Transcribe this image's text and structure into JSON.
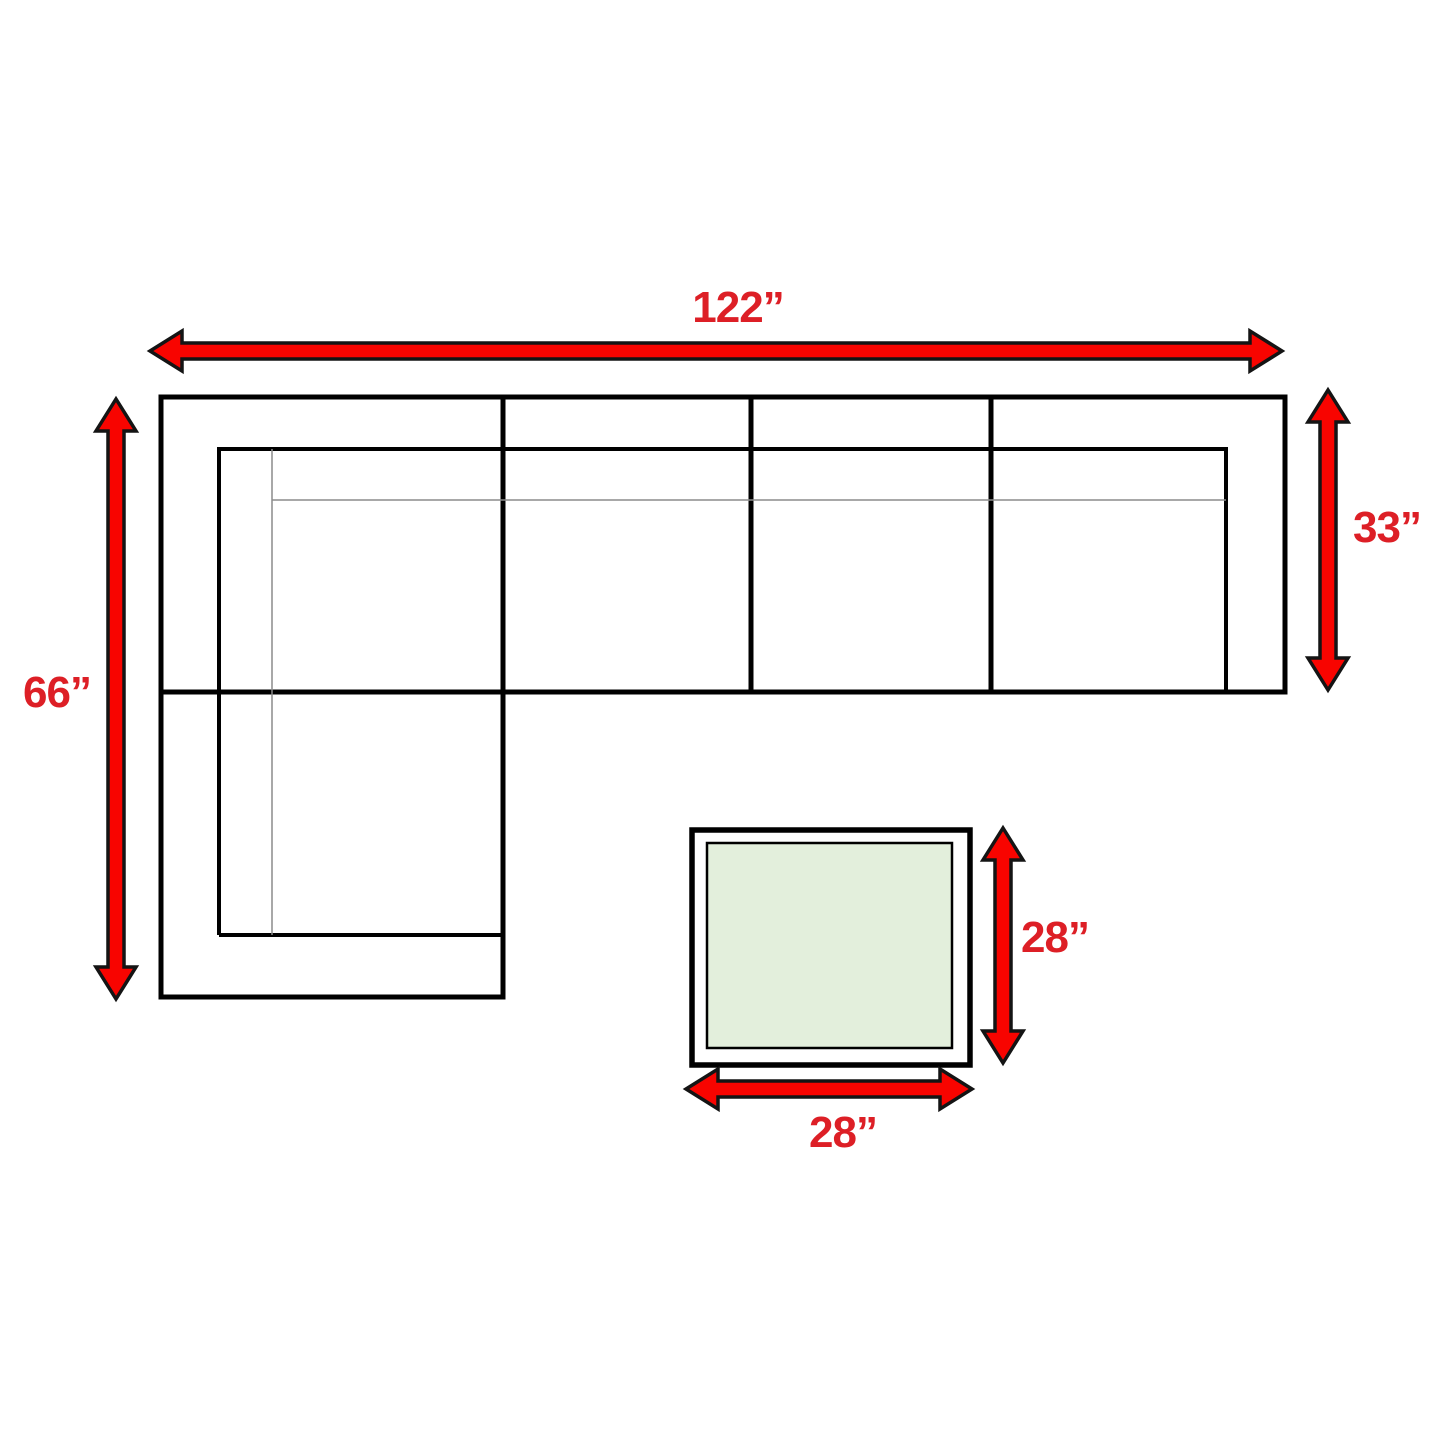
{
  "title": "Sectional sofa with table dimension diagram",
  "colors": {
    "background": "#FFFFFF",
    "arrow_fill": "#F80400",
    "arrow_outline": "#141414",
    "label_color": "#DD1F26",
    "sofa_line_color": "#000000",
    "thin_line_color": "#8C8C8C",
    "table_line_color": "#000000",
    "table_top_fill": "#E3EFDC"
  },
  "sofa": {
    "width_label": "122”",
    "depth_label": "66”",
    "section_depth_label": "33”",
    "width_in": 122,
    "depth_in": 66,
    "section_depth_in": 33
  },
  "table": {
    "depth_label": "28”",
    "width_label": "28”",
    "depth_in": 28,
    "width_in": 28
  }
}
